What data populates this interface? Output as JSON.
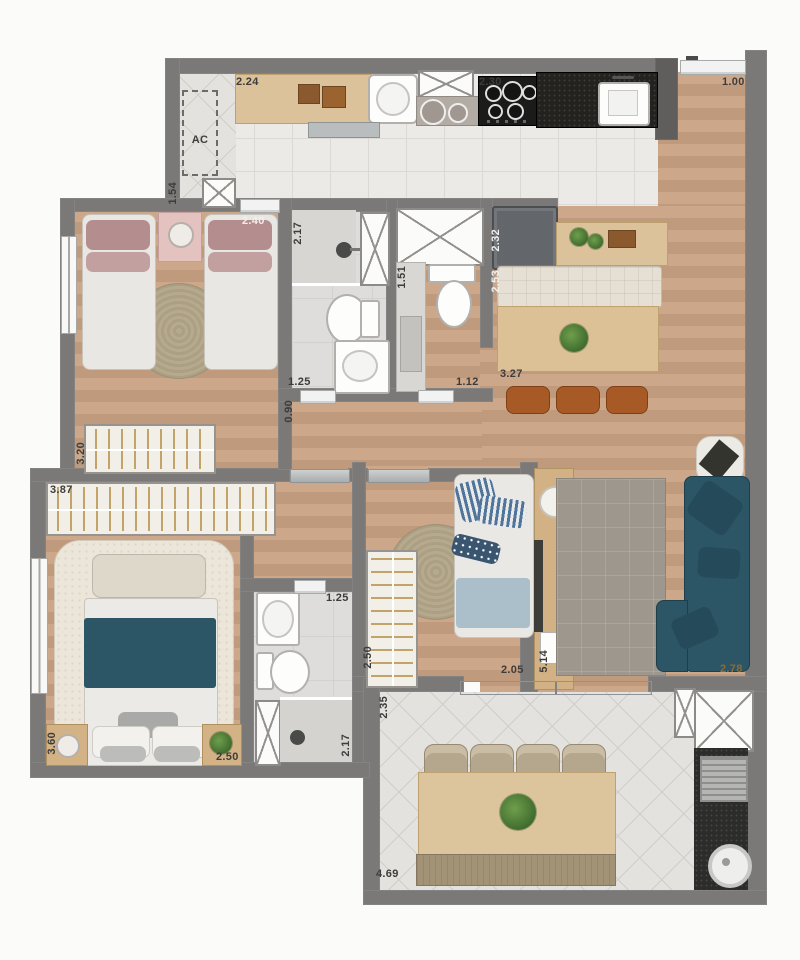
{
  "plan": {
    "dims": {
      "service_counter": "2.24",
      "ac": "AC",
      "service_width": "1.54",
      "stove_width": "2.30",
      "entry_width": "1.00",
      "bedroom1_width": "2.40",
      "bath1_length": "2.17",
      "fridge_width": "2.32",
      "bench_length": "2.53",
      "wc_length": "1.51",
      "island_length": "3.27",
      "bath1_width": "1.25",
      "wc_width": "1.12",
      "hall_width": "0.90",
      "closet1_length": "3.20",
      "closet2_length": "3.87",
      "closet3_length": "2.50",
      "bedroom3_width": "2.05",
      "living_length": "5.14",
      "living_width": "2.78",
      "master_length": "3.60",
      "master_width": "2.50",
      "ensuite_width": "1.25",
      "ensuite_length": "2.17",
      "terrace_depth": "2.35",
      "terrace_length": "4.69"
    },
    "colors": {
      "wall": "#7b7977",
      "wood_floor": "#c7a083",
      "kitchen_tile": "#eceae7",
      "sofa_teal": "#2c5565",
      "dark_counter": "#23221f",
      "label": "#3d3c3a",
      "label_bronze": "#8a6c35"
    }
  }
}
